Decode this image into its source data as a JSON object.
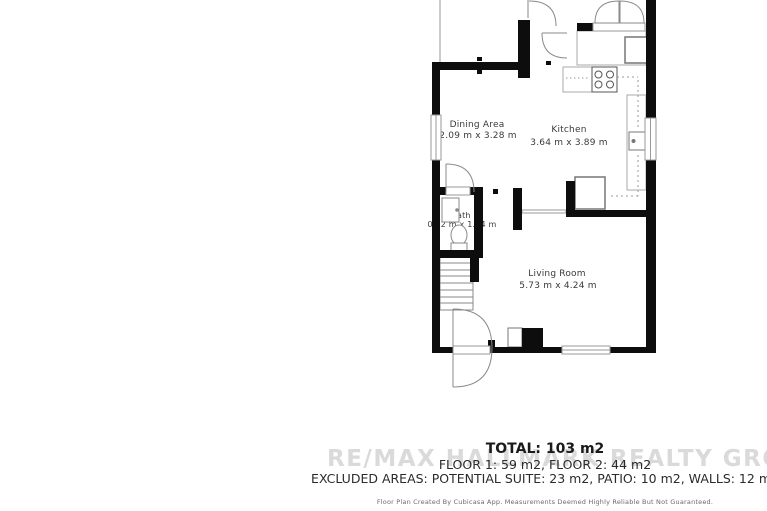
{
  "floorplan": {
    "rooms": [
      {
        "name": "Dining Area",
        "dims": "2.09 m x 3.28 m"
      },
      {
        "name": "Kitchen",
        "dims": "3.64 m x 3.89 m"
      },
      {
        "name": "Bath",
        "dims": "0.92 m x 1.74 m"
      },
      {
        "name": "Living Room",
        "dims": "5.73 m x 4.24 m"
      }
    ],
    "fixtures": [
      "staircase",
      "toilet",
      "bathroom-sink",
      "kitchen-sink",
      "stove-burners",
      "refrigerator",
      "counter",
      "fireplace",
      "entry-door",
      "french-doors",
      "window"
    ]
  },
  "summary": {
    "total": "TOTAL: 103 m2",
    "floors": "FLOOR 1: 59 m2, FLOOR 2: 44 m2",
    "excluded": "EXCLUDED AREAS: POTENTIAL SUITE: 23 m2, PATIO: 10 m2, WALLS: 12 m2"
  },
  "watermark": "RE/MAX HALLMARK REALTY GROUP, Brokerage",
  "footer": "Floor Plan Created By Cubicasa App. Measurements Deemed Highly Reliable But Not Guaranteed.",
  "colors": {
    "wall": "#0d0d0d",
    "fixture_line": "#8a8a8a",
    "label_text": "#3a3a3a",
    "watermark": "#dadada"
  }
}
